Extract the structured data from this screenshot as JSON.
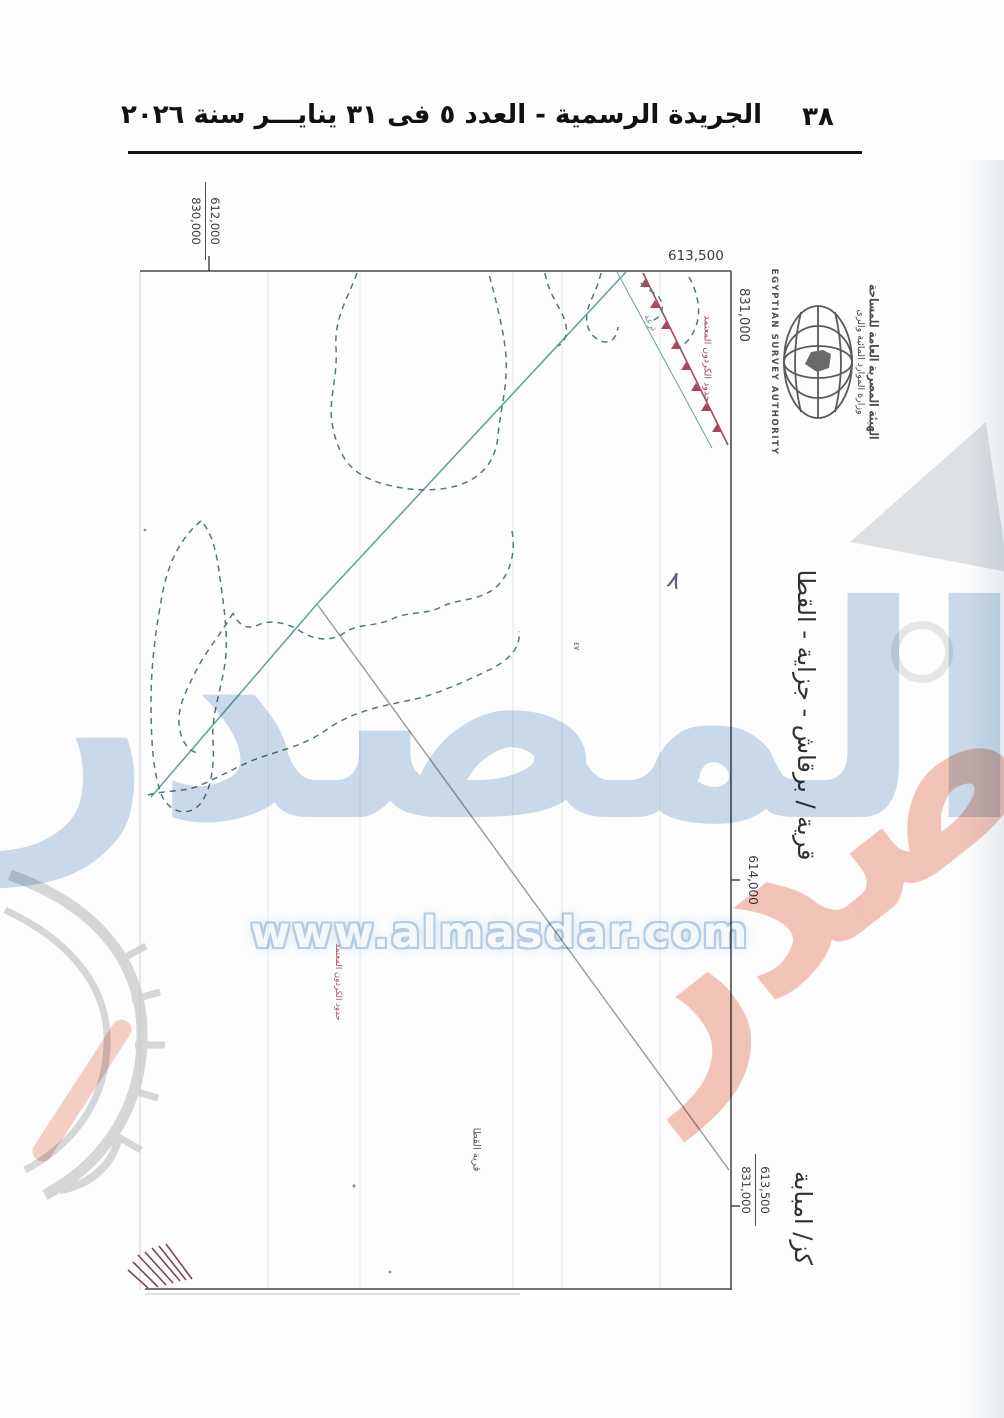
{
  "header": {
    "title": "الجريدة الرسمية - العدد ٥ فى ٣١ ينايـــر سنة ٢٠٢٦",
    "page_number": "٣٨"
  },
  "map": {
    "coords": {
      "top_left": {
        "left_value": "830,000",
        "right_value": "612,000"
      },
      "top_right": "613,500",
      "right_upper": "831,000",
      "right_mid": "614,000",
      "bottom_right": {
        "left_value": "831,000",
        "right_value": "613,500"
      }
    },
    "titles": {
      "region": "قرية / برقاش - جزاية - القطا",
      "district": "كز/ امبابة",
      "village_small": "قرية القطا"
    },
    "annotations": {
      "red_boundary_top": "حدود الكردون المعتمد",
      "red_boundary_mid": "حدود الكردون المعتمد",
      "canal_label": "ترعة",
      "handwritten_mark": "٨",
      "plot_number": "٤٧"
    },
    "logo": {
      "arabic_authority": "الهيئة المصرية العامة للمساحة",
      "arabic_ministry": "وزارة الموارد المائية والرى",
      "english": "EGYPTIAN SURVEY AUTHORITY"
    }
  },
  "watermarks": {
    "brand": "المصدر",
    "url": "www.almasdar.com",
    "pink_fragment": "ر"
  },
  "colors": {
    "boundary_teal": "#4d7a7a",
    "line_teal": "#66a39b",
    "line_gray": "#9a9a9a",
    "cordon_red": "#a8485c",
    "watermark_blue": "#cbdbeb",
    "watermark_pink": "#f2c5b8",
    "watermark_gray": "#c6c9cb"
  }
}
